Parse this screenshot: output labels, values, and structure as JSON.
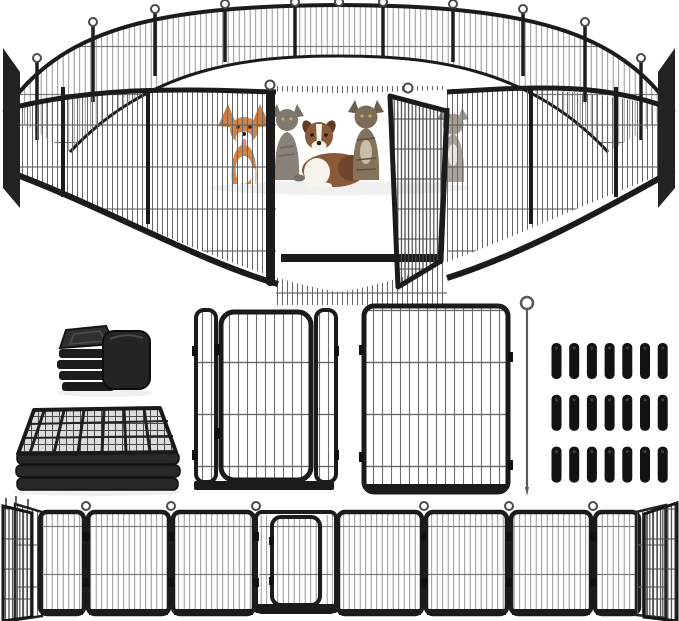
{
  "image": {
    "type": "product-photo",
    "subject": "heavy-duty metal pet playpen set",
    "background": "#ffffff",
    "width": 679,
    "height": 621
  },
  "palette": {
    "frame": "#1b1b1b",
    "wire_light": "#8c8c8c",
    "wire_mid": "#666666",
    "wire_dense": "#454545",
    "corgi": "#d08549",
    "aussie": "#8a5a38",
    "gray_cat": "#81796f",
    "tabby_cat": "#7d6d58",
    "pale_cat": "#a39d93",
    "tongue": "#e08a8a"
  },
  "scene": {
    "assembled_pen": {
      "label": "assembled circular playpen with open gate door",
      "visible_panels": 17,
      "gate_open": true,
      "pets": [
        {
          "id": "corgi",
          "label": "corgi dog"
        },
        {
          "id": "gray-cat",
          "label": "gray cat"
        },
        {
          "id": "australian-shepherd",
          "label": "australian shepherd dog"
        },
        {
          "id": "tabby-cat",
          "label": "long-haired tabby cat"
        },
        {
          "id": "pale-cat",
          "label": "gray and white cat behind open door"
        }
      ]
    },
    "accessories": {
      "end_caps": {
        "label": "rubber square tube end caps",
        "count": 2
      },
      "folded_stack": {
        "label": "stack of folded fence panels"
      },
      "gate_panel": {
        "label": "fence panel with walk-through door"
      },
      "plain_panel": {
        "label": "standard wire fence panel"
      },
      "ground_rod": {
        "label": "ground anchor rod with loop handle"
      },
      "ground_stakes": {
        "label": "ground stakes",
        "count": 21,
        "rows": 3,
        "columns": 7
      }
    },
    "panel_row": {
      "label": "fence panels connected in a straight row with center gate",
      "straight_panels": 7,
      "gate_panels": 1,
      "angled_end_panels": 2,
      "connector_rings": 6
    }
  }
}
